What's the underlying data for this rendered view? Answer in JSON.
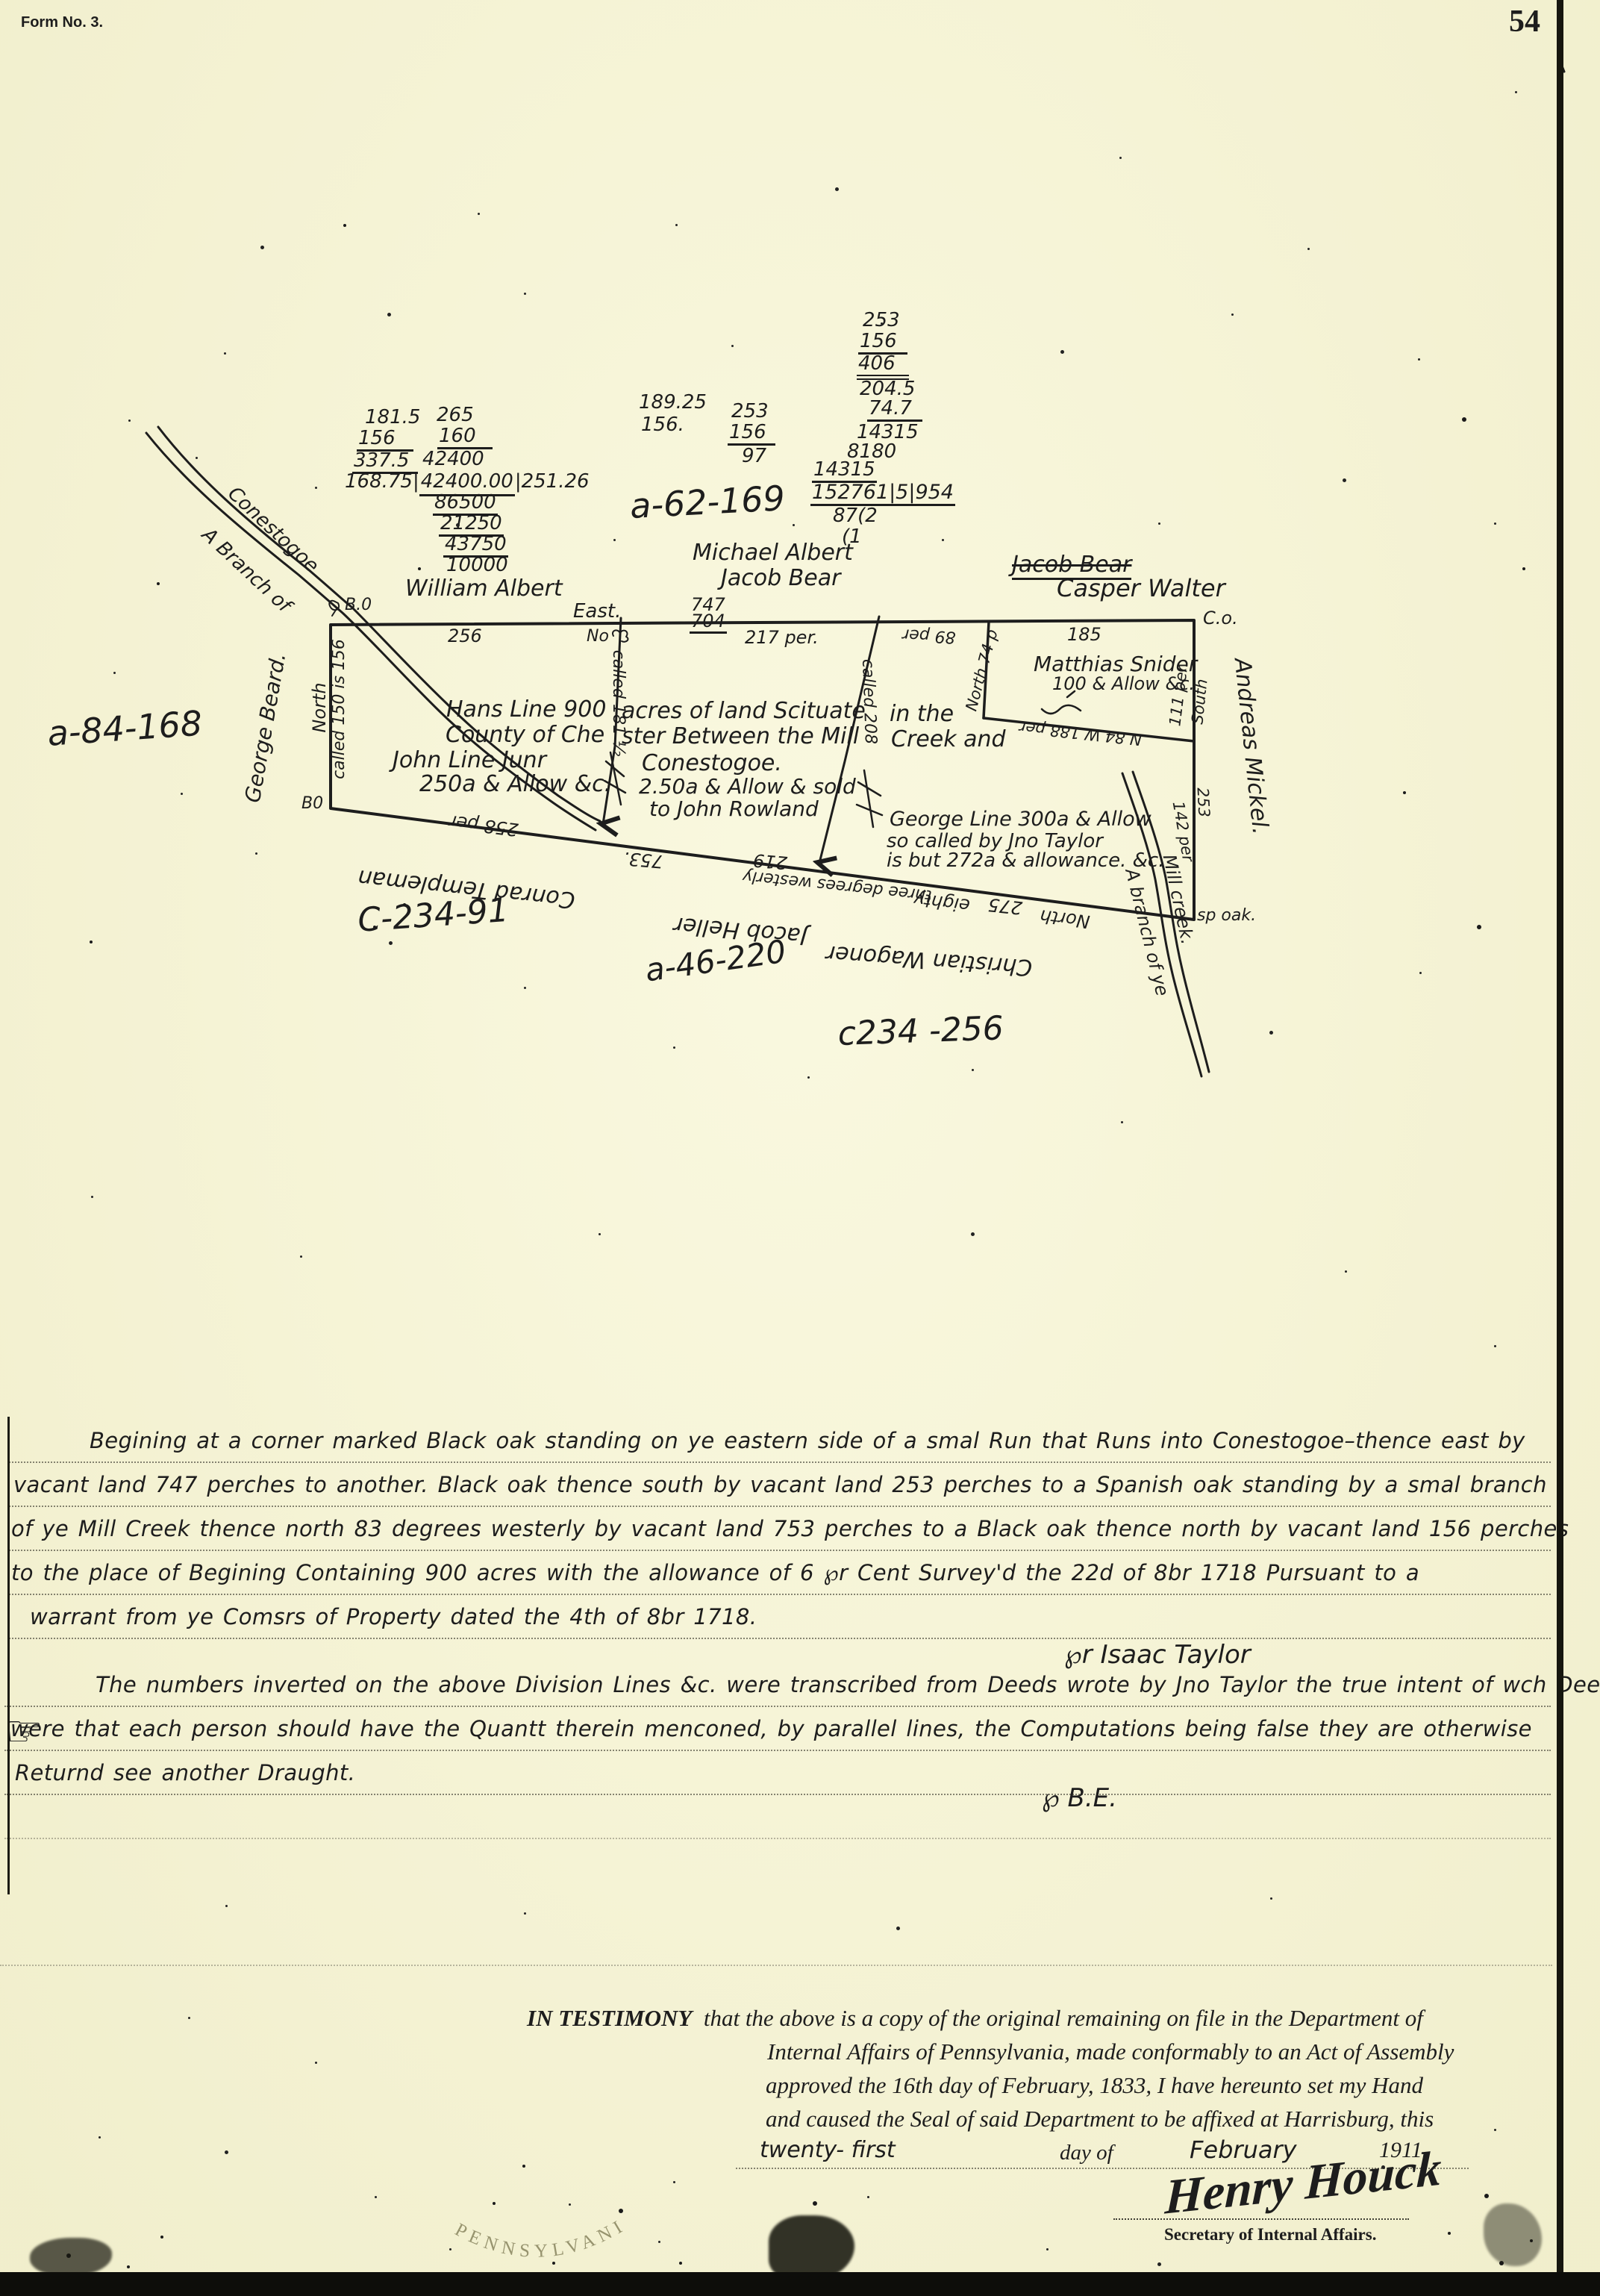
{
  "page": {
    "form_no": "Form No. 3.",
    "page_number": "54"
  },
  "calc": {
    "colA1": "181.5",
    "colA2": "156",
    "colA3": "337.5",
    "colB1": "265",
    "colB2": "160",
    "colB3": "42400",
    "divA": "168.75",
    "divB": "42400.00",
    "divC": "251.26",
    "stack1": "86500",
    "stack2": "21250",
    "stack3": "43750",
    "stack4": "10000",
    "mid1": "189.25",
    "mid2": "156.",
    "midB1": "253",
    "midB2": "156",
    "midB3": "97",
    "r1": "253",
    "r2": "156",
    "r3": "406",
    "r4": "204.5",
    "r5": "74.7",
    "r6": "14315",
    "r7": "8180",
    "r8": "14315",
    "r9": "152761|5|954",
    "r10": "87(2",
    "r11": "(1"
  },
  "ids": {
    "a62": "a-62-169",
    "a84": "a-84-168",
    "c234_91": "C-234-91",
    "a46": "a-46-220",
    "c234_256": "c234 -256"
  },
  "names": {
    "william": "William Albert",
    "michael": "Michael Albert",
    "jacob": "Jacob Bear",
    "jacob_struck": "Jacob Bear",
    "casper": "Casper Walter",
    "george_beard": "George Beard.",
    "andreas": "Andreas Mickel.",
    "conrad": "Conrad Templeman",
    "heller": "Jacob Heller",
    "wagoner": "Christian Wagoner"
  },
  "plat": {
    "corner_bo_top": "B.0",
    "corner_bo_bottom": "B0",
    "corner_co": "C.o.",
    "corner_spoak": "sp oak.",
    "east": "East.",
    "e256": "256",
    "no_mark": "No",
    "e747": "747",
    "e704": "704",
    "e217": "217 per.",
    "e89": "89 per",
    "e185": "185",
    "north_left": "North",
    "called_left": "called 150 is 156",
    "called_d1": "called 181 ½",
    "called_d2": "called 208",
    "snider_name": "Matthias Snider",
    "snider_allow": "100 & Allow &c.",
    "north74": "North 74 p",
    "per111": "111 per.",
    "south": "South",
    "snider_bottom": "N 84 W 188 per",
    "e253": "253",
    "e142": "142 per",
    "b258": "258 per",
    "b753": "753.",
    "b219": "219",
    "b_mid": "three degrees westerly",
    "b_eighty": "eighty",
    "b275": "275",
    "b_north": "North",
    "t1a": "Hans Line 900",
    "t1b": "acres of land Scituate",
    "t1c": "in the",
    "t2a": "County of Che",
    "t2b": "ster Between the Mill",
    "t2c": "Creek and",
    "t3a": "John Line Junr",
    "t3b": "Conestogoe.",
    "t4a": "250a & Allow &c.",
    "t4b": "2.50a & Allow & sold",
    "t5b": "to John Rowland",
    "g1": "George Line 300a & Allow",
    "g2": "so called by Jno Taylor",
    "g3": "is but 272a & allowance. &c.",
    "creek_up1": "A Branch of",
    "creek_up2": "Conestogoe",
    "creek_lo1": "A branch of ye",
    "creek_lo2": "Mill creek."
  },
  "desc": {
    "pointer": "☞",
    "p1": "Begining at a corner marked Black oak standing on ye eastern side of a smal Run that Runs into Conestogoe–thence east by",
    "p2": "vacant land 747 perches to another. Black oak thence south by vacant land 253 perches to a Spanish oak standing by a smal branch",
    "p3": "of ye Mill Creek thence north 83 degrees westerly by vacant land 753 perches to a Black oak thence north by vacant land 156 perches",
    "p4": "to the place of Begining Containing 900 acres with the allowance of 6 ℘r Cent Survey'd the 22d of 8br 1718 Pursuant to a",
    "p5": "warrant from ye Comsrs of Property dated the 4th of 8br 1718.",
    "taylor": "℘r Isaac Taylor",
    "p6": "The numbers inverted on the above Division Lines &c. were transcribed from Deeds wrote by Jno Taylor the true intent of wch Deeds",
    "p7": "were that each person should have the Quantt therein menconed, by parallel lines, the Computations being false they are otherwise",
    "p8": "Returnd see another Draught.",
    "be": "℘   B.E."
  },
  "testimony": {
    "lead": "IN TESTIMONY",
    "l1": "that the above is a copy of the original remaining on file in the Department of",
    "l2": "Internal Affairs of Pennsylvania, made conformably to an Act of Assembly",
    "l3": "approved the 16th day of February, 1833, I have hereunto set my Hand",
    "l4": "and caused the Seal of said Department to be affixed at Harrisburg, this",
    "day": "twenty- first",
    "day_of": "day of",
    "month": "February",
    "year": "1911.",
    "signature": "Henry Houck",
    "sig_title": "Secretary of Internal Affairs."
  },
  "seal": {
    "text": "PENNSYLVANIA"
  },
  "colors": {
    "paper": "#f8f6d8",
    "ink": "#1d1d1d"
  }
}
